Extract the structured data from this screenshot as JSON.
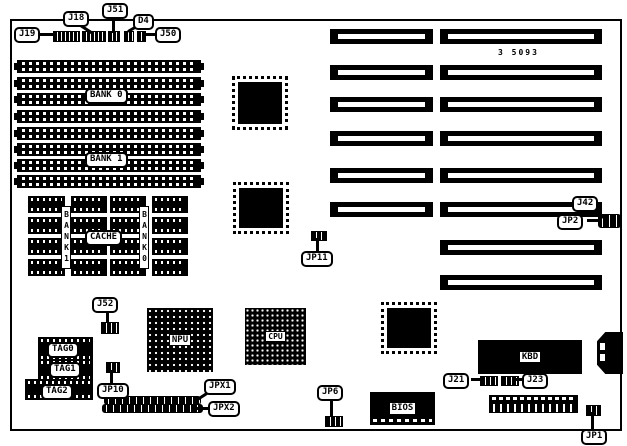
{
  "colors": {
    "ink": "#000000",
    "paper": "#ffffff"
  },
  "board": {
    "part_number": "3 5093"
  },
  "callouts": {
    "j19": "J19",
    "j18": "J18",
    "j51": "J51",
    "d4": "D4",
    "j50": "J50",
    "j42": "J42",
    "jp2": "JP2",
    "jp11": "JP11",
    "j52": "J52",
    "jp10": "JP10",
    "jpx1": "JPX1",
    "jpx2": "JPX2",
    "jp6": "JP6",
    "j21": "J21",
    "j23": "J23",
    "jp1": "JP1"
  },
  "labels": {
    "bank0": "BANK 0",
    "bank1": "BANK 1",
    "cache": "CACHE",
    "cache_bank1_vertical": "BANK1",
    "cache_bank0_vertical": "BANK0",
    "tag0": "TAG0",
    "tag1": "TAG1",
    "tag2": "TAG2",
    "npu": "NPU",
    "cpu": "CPU",
    "kbd": "KBD",
    "bios": "BIOS"
  }
}
